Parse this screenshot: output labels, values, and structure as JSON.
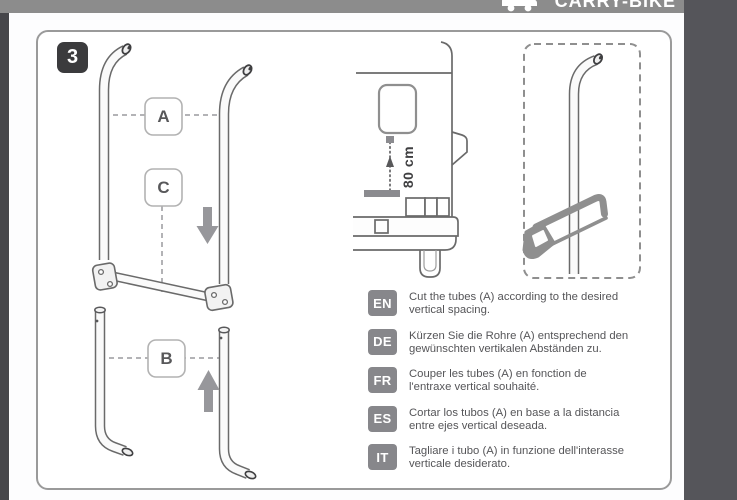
{
  "header": {
    "brand": "CARRY-BIKE",
    "brand_icon": "van-with-bike-icon"
  },
  "panel": {
    "step_number": "3",
    "labels": {
      "a": "A",
      "b": "B",
      "c": "C"
    },
    "measurement_label": "80 cm"
  },
  "instructions": [
    {
      "lang": "EN",
      "text": "Cut the tubes (A) according to the desired\nvertical spacing."
    },
    {
      "lang": "DE",
      "text": "Kürzen Sie die Rohre (A) entsprechend den\ngewünschten vertikalen Abständen zu."
    },
    {
      "lang": "FR",
      "text": "Couper les tubes (A) en fonction de\nl'entraxe vertical souhaité."
    },
    {
      "lang": "ES",
      "text": "Cortar los tubos (A) en base a la distancia\nentre ejes vertical deseada."
    },
    {
      "lang": "IT",
      "text": "Tagliare i tubo (A) in funzione dell'interasse\nverticale desiderato."
    }
  ],
  "colors": {
    "header_bar": "#8c8c8c",
    "side_strip_left": "#46464a",
    "side_strip_right": "#55555a",
    "panel_border": "#9a9a9a",
    "step_badge_bg": "#3b3b3d",
    "lang_badge_bg": "#87878b",
    "body_text": "#555558",
    "line_art": "#6a6a6a",
    "tool_gray": "#8f8f8f"
  }
}
